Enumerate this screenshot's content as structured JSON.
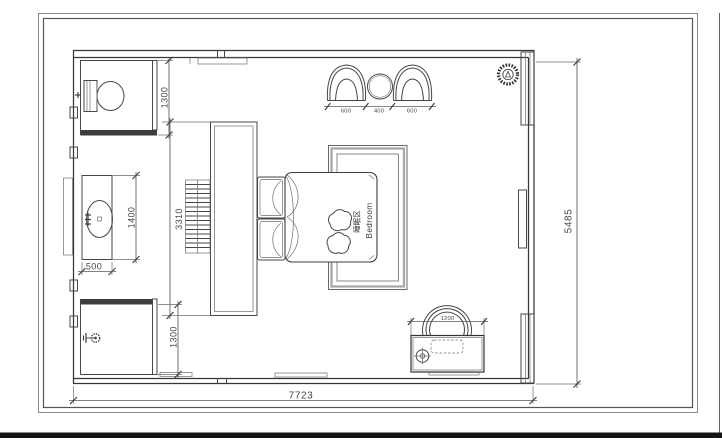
{
  "plan": {
    "room": {
      "label_zh": "睡眠区",
      "label_en": "Bedroom"
    },
    "dims": {
      "overall_width": "7723",
      "overall_depth": "5485",
      "wc_depth": "1300",
      "shower_depth": "1300",
      "wardrobe_length": "3310",
      "vanity_length": "1400",
      "vanity_depth": "500",
      "armchair_left": "600",
      "side_table": "400",
      "armchair_right": "600",
      "desk_width": "1200"
    }
  }
}
